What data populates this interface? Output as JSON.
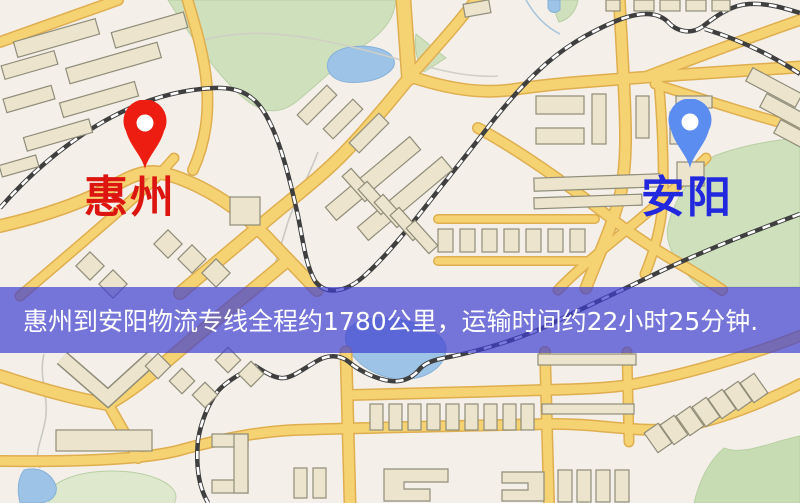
{
  "banner": {
    "text": "惠州到安阳物流专线全程约1780公里，运输时间约22小时25分钟.",
    "background_color": "#3e3ed0",
    "text_color": "#ffffff"
  },
  "route": {
    "origin": "惠州",
    "destination": "安阳",
    "distance_text": "约1780公里",
    "duration_text": "约22小时25分钟"
  },
  "pins": {
    "origin": {
      "label": "惠州",
      "pin_color": "#ee1d12",
      "label_color": "#dd1510"
    },
    "destination": {
      "label": "安阳",
      "pin_color": "#5b8cf0",
      "label_color": "#2228de"
    }
  },
  "map_colors": {
    "background": "#f4f0e9",
    "road": "#f5d272",
    "road_casing": "#dfae4f",
    "building": "#ece4cc",
    "park": "#cfe0bc",
    "water": "#9dc3e6",
    "railway": "#3f3f3f"
  }
}
